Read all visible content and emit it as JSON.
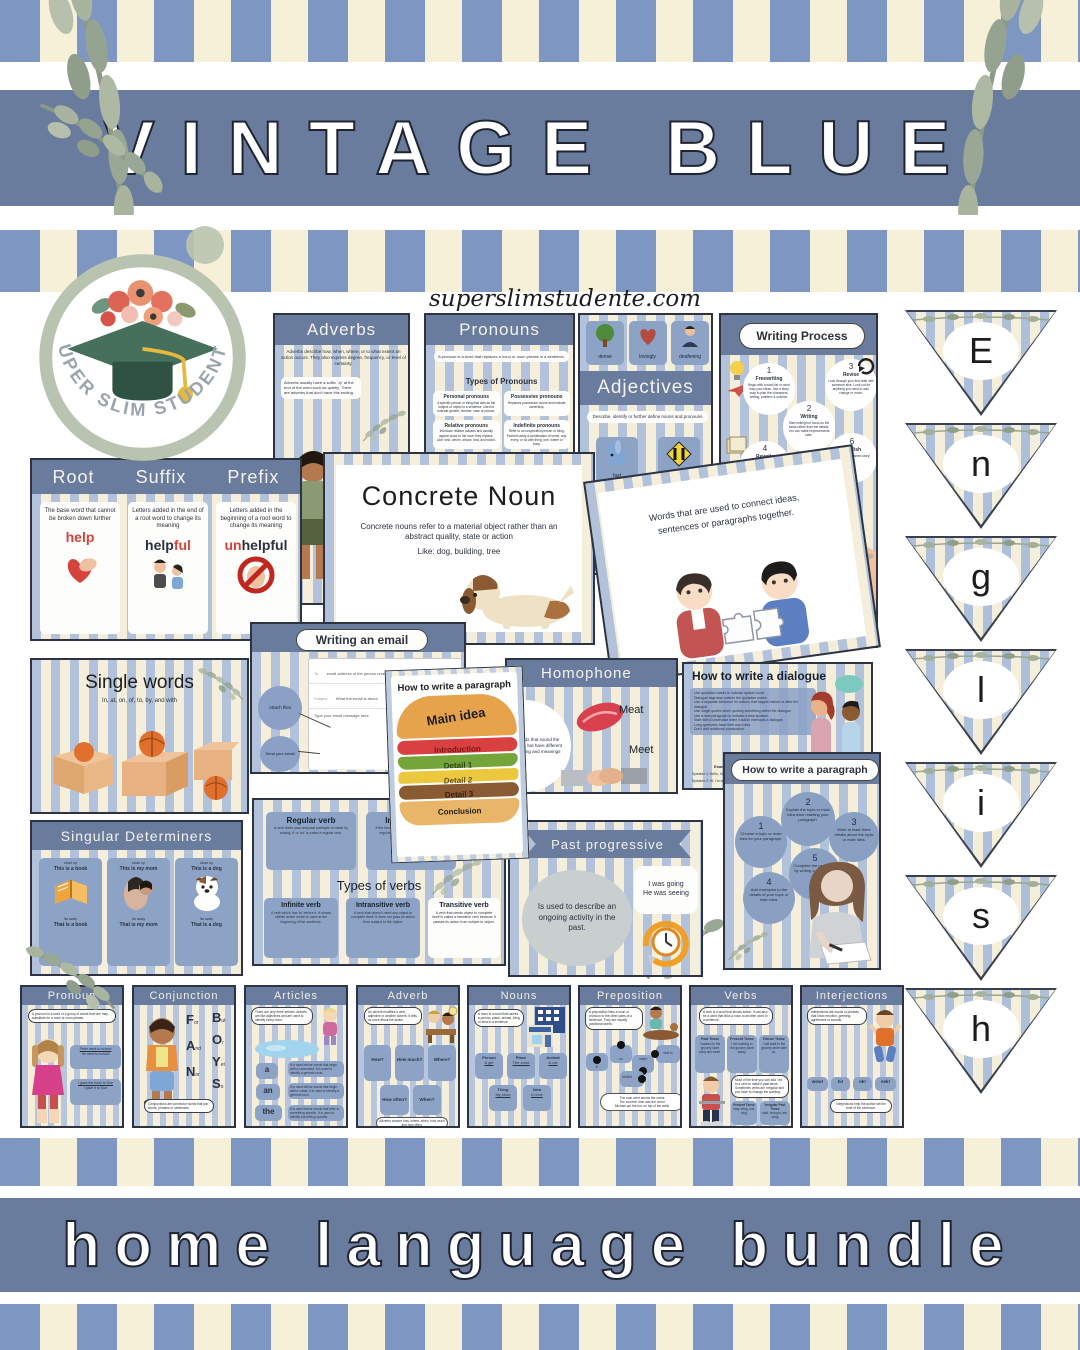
{
  "site": {
    "url": "superslimstudente.com"
  },
  "top_banner": {
    "title": "VINTAGE BLUE"
  },
  "bottom_banner": {
    "title": "home language bundle"
  },
  "logo": {
    "text": "SUPER SLIM STUDENTE"
  },
  "pennants": {
    "letters": [
      "E",
      "n",
      "g",
      "l",
      "i",
      "s",
      "h"
    ]
  },
  "cards": {
    "adverbs": {
      "title": "Adverbs",
      "intro": "Adverbs describe how, when, where, or to what extent an action occurs. They also express degree, frequency, or level of certainty.",
      "note_suffix": "Adverbs usually have a suffix '-ly' at the end of the word such as quietly. There are adverbs that don't have this ending.",
      "note_position": "Adverbs that modify an adjective or another adverb usually appear in front of the word they modify. Adverbs that modify a verb can appear before or after the verb, or at the beginning of the sentence."
    },
    "pronouns": {
      "title": "Pronouns",
      "intro": "A pronoun is a word that replaces a noun or noun phrase in a sentence.",
      "subtitle": "Types of Pronouns",
      "types": [
        {
          "name": "Personal pronouns",
          "desc": "A specific person or thing that acts as the subject or object in a sentence. Used to indicate gender, number, case or person."
        },
        {
          "name": "Possessive pronouns",
          "desc": "Replaces possessive nouns and indicate ownership."
        },
        {
          "name": "Relative pronouns",
          "desc": "Introduce relative clauses and usually appear close to the noun they replace. Like: who, whom, whose, that, and which."
        },
        {
          "name": "Indefinite pronouns",
          "desc": "Refer to an unspecified person or thing. Formed using a combination of some, any, every, or no with thing, one, where or body."
        },
        {
          "name": "Reflexive pronouns",
          "desc": "End with -self or -selves and are used when the subject and the object of a sentence are the same."
        },
        {
          "name": "Reciprocal pronouns",
          "desc": "Express mutual relationships or actions. Like: each other and one another."
        }
      ]
    },
    "adjectives": {
      "title": "Adjectives",
      "intro": "Describe, identify or further define nouns and pronouns",
      "examples": [
        "dense",
        "lovingly",
        "deafening",
        "fast",
        "narrow"
      ]
    },
    "writing_process": {
      "title": "Writing Process",
      "steps": [
        {
          "num": "1",
          "name": "Freewriting",
          "desc": "Begin with a word list or mind map your ideas. Use a story map to plan the characters, setting, problem & solution."
        },
        {
          "num": "2",
          "name": "Writing",
          "desc": "Start writing but focus on the ideas rather than the details. You can make improvements later."
        },
        {
          "num": "3",
          "name": "Revise",
          "desc": "Look through your first draft with someone else. Look out for anything you need to add, change or move."
        },
        {
          "num": "4",
          "name": "Rewrite",
          "desc": "Go back on your first draft and make the changes you identified in the revision stage."
        },
        {
          "num": "5",
          "name": "Proofread",
          "desc": "Correct any spelling, grammar and punctuation errors. Make sure that your writing flows correctly."
        },
        {
          "num": "6",
          "name": "Publish",
          "desc": "Share your finished story!"
        }
      ]
    },
    "affixes": {
      "root": {
        "title": "Root",
        "desc": "The base word that cannot be broken down further",
        "example": "help"
      },
      "suffix": {
        "title": "Suffix",
        "desc": "Letters added in the end of a root word to change its meaning",
        "ex_black": "help",
        "ex_red": "ful"
      },
      "prefix": {
        "title": "Prefix",
        "desc": "Letters added in the beginning of a root word to change its meaning",
        "ex_red": "un",
        "ex_black": "helpful"
      }
    },
    "concrete_noun": {
      "title": "Concrete Noun",
      "line1": "Concrete nouns refer to a material object rather than an abstract quality, state or action",
      "line2": "Like: dog, building, tree"
    },
    "connectors": {
      "text": "Words that are used to connect ideas, sentences or paragraphs together."
    },
    "single_words": {
      "title": "Single words",
      "subtitle": "In, at, on, of, to, by, and with"
    },
    "email": {
      "title": "Writing an email",
      "to_label": "To",
      "to_hint": "email address of the person receiving the email",
      "subject_label": "Subject",
      "subject_hint": "What the email is about",
      "body_hint": "Type your email message here",
      "attach_note": "Attach files",
      "send_note": "Send your email",
      "send_button": "Send"
    },
    "burger": {
      "title": "How to write a paragraph",
      "layers": [
        "Main idea",
        "Introduction",
        "Detail 1",
        "Detail 2",
        "Detail 3",
        "Conclusion"
      ]
    },
    "homophone": {
      "title": "Homophone",
      "desc": "Words that sound the same, but have different spelling and meanings",
      "example1": "Meat",
      "example2": "Meet"
    },
    "dialogue": {
      "title": "How to write a dialogue",
      "bullets": [
        "Use quotation marks to indicate spoken word.",
        "Dialogue tags stay outside the quotation marks.",
        "Use a separate sentence for actions that happen before or after the dialogue.",
        "Use single quotes when quoting something within the dialogue.",
        "Use a new paragraph to indicate a new speaker.",
        "Start with a lowercase letter if action interrupts a dialogue.",
        "Long speeches have their own rules.",
        "Don't add additional punctuation."
      ],
      "example_label": "Example:",
      "example_line1": "Speaker 1: Hello, how are you?",
      "example_line2": "Speaker 2: Hi, I'm well thanks."
    },
    "paragraph_steps": {
      "title": "How to write a paragraph",
      "steps": [
        {
          "num": "1",
          "text": "Choose a topic or main idea for your paragraph."
        },
        {
          "num": "2",
          "text": "Explain the topic or main idea when starting your paragraph."
        },
        {
          "num": "3",
          "text": "Write at least three details about the topic or main idea."
        },
        {
          "num": "4",
          "text": "Add examples to the details of your topic or main idea."
        },
        {
          "num": "5",
          "text": "Complete the paragraph by writing a conclusion."
        }
      ]
    },
    "verb_types": {
      "subtitle": "Types of verbs",
      "regular": {
        "name": "Regular verb",
        "desc": "A verb that's past and past participle is made by adding 'd' or 'ed' is called a regular verb."
      },
      "irregular": {
        "name": "Irregular verb",
        "desc": "If the formation of the verb is otherwise than a regular verb, it is called an irregular verb."
      },
      "infinite": {
        "name": "Infinite verb",
        "desc": "A verb which has 'to' before it. It shows infinite action which is used at the beginning of the sentence."
      },
      "intransitive": {
        "name": "Intransitive verb",
        "desc": "A verb that doesn't need any object to complete itself. It does not pass its action from subject to the object."
      },
      "transitive": {
        "name": "Transitive verb",
        "desc": "A verb that needs object to complete itself is called a transitive verb because it passes its action from subject to object."
      }
    },
    "past_progressive": {
      "title": "Past progressive",
      "desc": "Is used to describe an ongoing activity in the past.",
      "example1": "I was going",
      "example2": "He was seeing"
    },
    "determiners": {
      "title": "Singular Determiners",
      "items": [
        {
          "tag_near": "close up",
          "near": "This is a book",
          "tag_far": "far away",
          "far": "That is a book"
        },
        {
          "tag_near": "close up",
          "near": "This is my mom",
          "tag_far": "far away",
          "far": "That is my mom"
        },
        {
          "tag_near": "close up",
          "near": "This is a dog",
          "tag_far": "far away",
          "far": "That is a dog"
        }
      ]
    }
  },
  "posters": [
    {
      "title": "Pronoun",
      "bubble": "A pronoun is a word or a group of words that one may substitute for a noun or noun phrase.",
      "box1_line1": "Peter went to school",
      "box1_line2": "He went to school",
      "box2_line1": "I gave the book to Sue",
      "box2_line2": "I gave it to Sue"
    },
    {
      "title": "Conjunction",
      "fanboys": [
        {
          "cap": "F",
          "rest": "or"
        },
        {
          "cap": "A",
          "rest": "nd"
        },
        {
          "cap": "N",
          "rest": "or"
        },
        {
          "cap": "B",
          "rest": "ut"
        },
        {
          "cap": "O",
          "rest": "r"
        },
        {
          "cap": "Y",
          "rest": "et"
        },
        {
          "cap": "S",
          "rest": "o"
        }
      ],
      "bubble": "Conjunctions are connector words that join words, phrases or sentences."
    },
    {
      "title": "Articles",
      "bubble": "There are only three articles. Articles are like adjectives and are used to identify every noun.",
      "words": [
        "a",
        "an",
        "the"
      ],
      "notes": [
        "It is used before words that begin with a consonant. It is used to identify a general noun.",
        "It is used before words that begin with a vowel. It is used to identify a general noun.",
        "It is used before words that refer to something specific. It is used to identify something specific."
      ]
    },
    {
      "title": "Adverb",
      "bubble": "An adverb modifies a verb, adjective or another adverb. It tells us more about the action.",
      "boxes": [
        "How?",
        "How much?",
        "Where?",
        "How often?",
        "When?"
      ],
      "note": "Adverbs answer how, where, when, how much and how often."
    },
    {
      "title": "Nouns",
      "bubble": "A noun is a word that names a person, place, animal, thing or idea in a sentence.",
      "boxes": [
        {
          "label": "Person",
          "word": "A girl"
        },
        {
          "label": "Place",
          "word": "The store"
        },
        {
          "label": "Animal",
          "word": "A cat"
        },
        {
          "label": "Thing",
          "word": "My shoe"
        },
        {
          "label": "Idea",
          "word": "In love"
        }
      ]
    },
    {
      "title": "Preposition",
      "bubble": "A preposition links a noun or pronoun to the other parts of a sentence. They are usually positional words.",
      "words": [
        "in",
        "on",
        "under",
        "next to",
        "behind"
      ],
      "ex1": "The man went across the roads",
      "ex2": "The summer time was the worst",
      "ex3": "Michael put the box on top of the walls"
    },
    {
      "title": "Verbs",
      "bubble": "A verb is a word that shows action. It can also be a word that links a noun to another word in a sentence.",
      "tenses": [
        {
          "label": "Past Tense",
          "desc": "I walked to the grocery store early last week."
        },
        {
          "label": "Present Tense",
          "desc": "I am walking to the grocery store today."
        },
        {
          "label": "Future Tense",
          "desc": "I will walk to the grocery store later on."
        }
      ],
      "bubble2": "Most of the time you can add '-ed' to a verb to make it past tense. Sometimes verbs are irregular and you have to change the spelling.",
      "list1_label": "Present Tense",
      "list1_items": "stay, bring, eat, sing",
      "list2_label": "Irregular Past Tense",
      "list2_items": "said, brought, ate, sang"
    },
    {
      "title": "Interjections",
      "bubble": "Interjections are words or phrases that show emotion, greeting, agreement or sounds.",
      "words": [
        "wow!",
        "hi!",
        "ok!",
        "eek!"
      ],
      "note": "Interjections help the author set the tone of the sentence."
    }
  ]
}
